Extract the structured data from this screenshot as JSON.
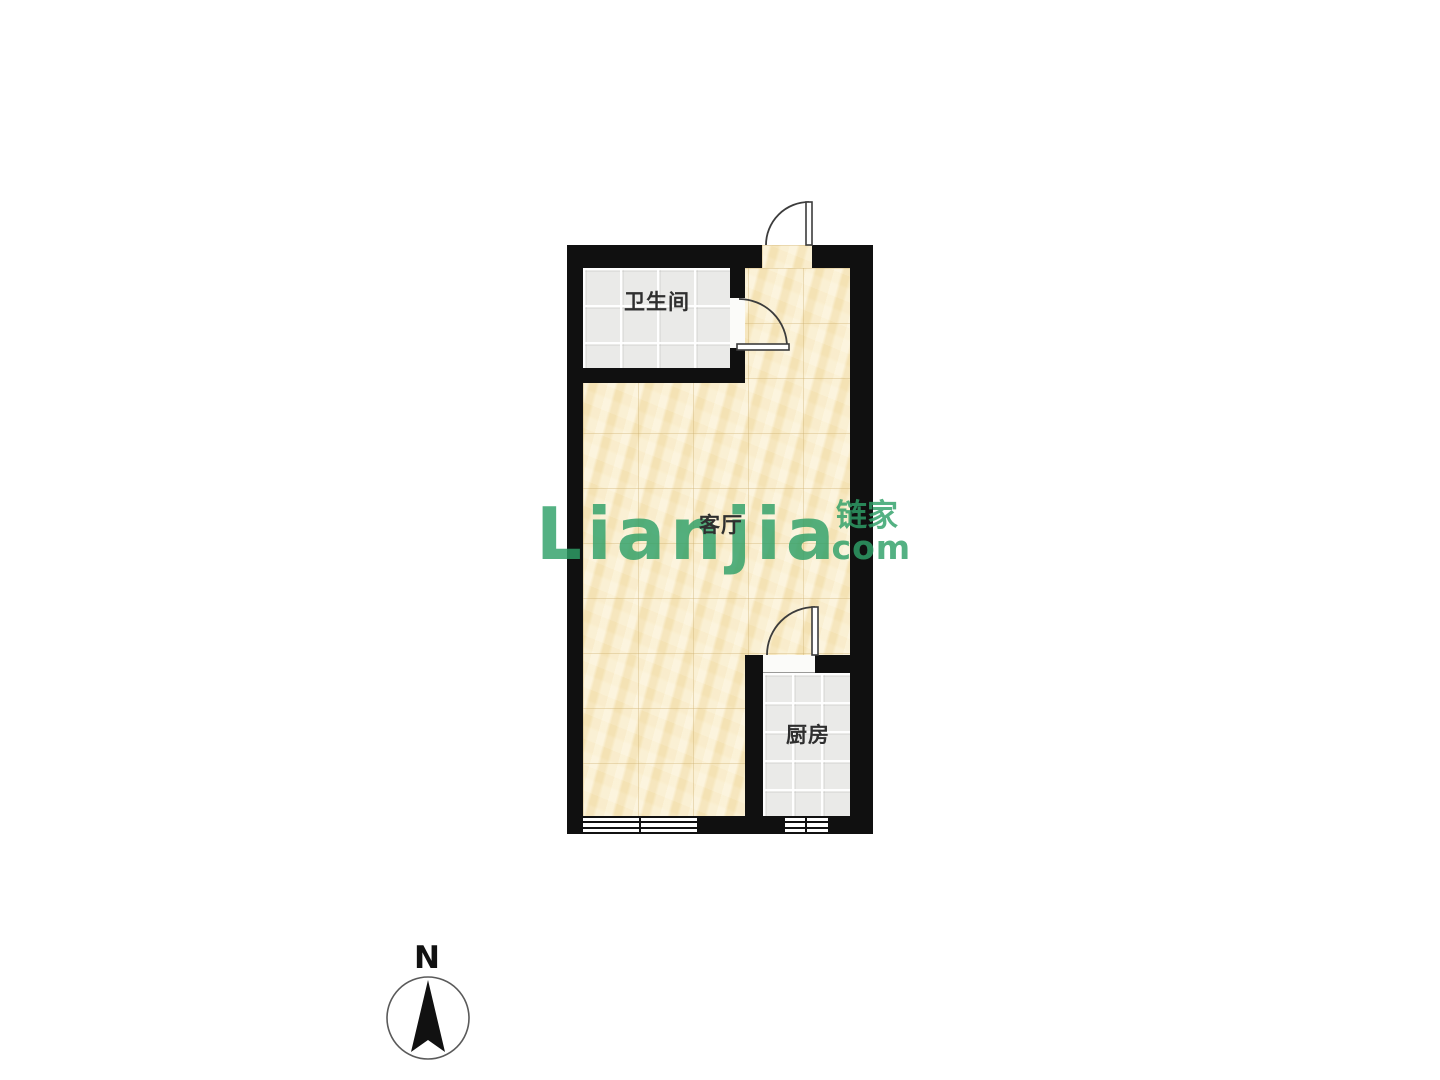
{
  "page": {
    "background_color": "#ffffff"
  },
  "floorplan": {
    "rooms": [
      {
        "name": "bathroom",
        "label": "卫生间",
        "floor": "gray-tile"
      },
      {
        "name": "living-room",
        "label": "客厅",
        "floor": "yellow-marble"
      },
      {
        "name": "kitchen",
        "label": "厨房",
        "floor": "gray-tile"
      }
    ],
    "colors": {
      "wall": "#101010",
      "living_floor": "#F7E9C2",
      "tile_floor": "#EAEAE8",
      "door_stroke": "#3C3C3C"
    },
    "features": {
      "doors": [
        "entry-door",
        "bathroom-door",
        "kitchen-door"
      ],
      "windows": [
        "living-room-window",
        "kitchen-window"
      ]
    }
  },
  "watermark": {
    "brand_latin": "Lianjia",
    "brand_cjk": "链家",
    "brand_domain": ".com",
    "color": "#2FA068"
  },
  "compass": {
    "label": "N"
  }
}
